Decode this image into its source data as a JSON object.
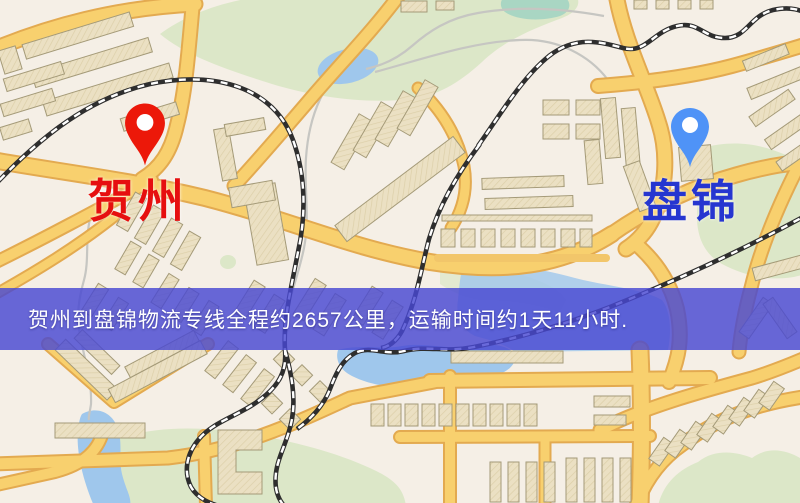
{
  "banner": {
    "text": "贺州到盘锦物流专线全程约2657公里，运输时间约1天11小时."
  },
  "origin": {
    "name": "贺州"
  },
  "destination": {
    "name": "盘锦"
  },
  "route": {
    "distance_text": "约2657公里",
    "duration_text": "约1天11小时"
  },
  "colors": {
    "origin_label": "#e60f0f",
    "origin_pin": "#ec1809",
    "destination_label": "#2636d0",
    "destination_pin": "#4f93f7",
    "banner_bg": "#4848d2",
    "banner_text": "#ffffff",
    "road_fill": "#f8d06e",
    "road_casing": "#e3aa50",
    "park": "#dce7c8",
    "water": "#9fc7ec",
    "pond_teal": "#a9d6c3",
    "building": "#ebe0c3",
    "railway": "#2e2e2e",
    "map_background": "#f5efe6"
  }
}
